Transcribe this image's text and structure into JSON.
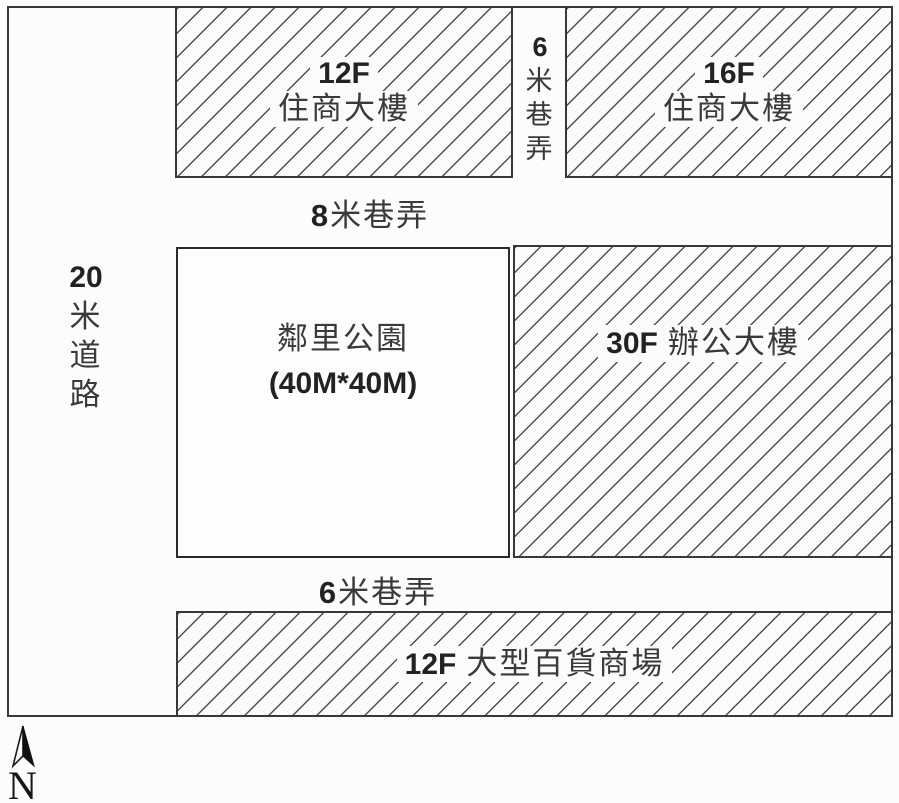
{
  "colors": {
    "background": "#fcfcfc",
    "line": "#383838",
    "hatch": "#4f4f4f",
    "text_cjk": "#3a3a3a",
    "text_num": "#222222"
  },
  "blocks": {
    "residential_nw": {
      "floors": "12F",
      "name": "住商大樓"
    },
    "residential_ne": {
      "floors": "16F",
      "name": "住商大樓"
    },
    "office": {
      "floors": "30F",
      "name": "辦公大樓"
    },
    "department_store": {
      "floors": "12F",
      "name": "大型百貨商場"
    },
    "park": {
      "name": "鄰里公園",
      "size": "(40M*40M)"
    }
  },
  "roads": {
    "west_road": {
      "chars": [
        "20",
        "米",
        "道",
        "路"
      ]
    },
    "north_alley": {
      "chars": [
        "6",
        "米",
        "巷",
        "弄"
      ]
    },
    "middle_alley": {
      "width_num": "8",
      "suffix": "米巷弄"
    },
    "south_alley": {
      "width_num": "6",
      "suffix": "米巷弄"
    }
  },
  "compass": {
    "north_label": "N"
  }
}
